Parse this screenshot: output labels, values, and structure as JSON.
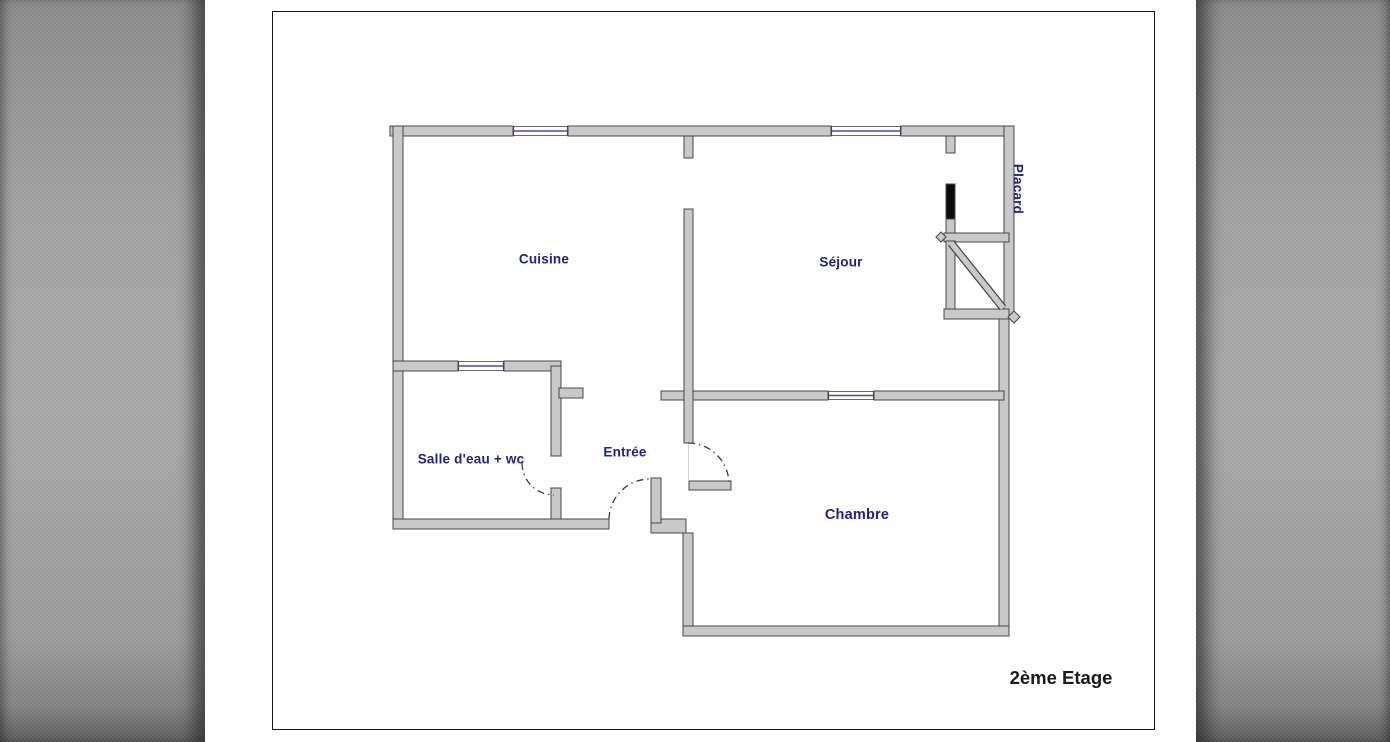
{
  "page": {
    "floor_title": "2ème Etage"
  },
  "rooms": {
    "cuisine": {
      "label": "Cuisine"
    },
    "sejour": {
      "label": "Séjour"
    },
    "placard": {
      "label": "Placard"
    },
    "salle_eau": {
      "label": "Salle d'eau + wc"
    },
    "entree": {
      "label": "Entrée"
    },
    "chambre": {
      "label": "Chambre"
    }
  },
  "colors": {
    "wall_fill": "#c9c9c9",
    "wall_outline": "#474747",
    "room_label": "#20208c",
    "title_text": "#1b1b1b",
    "window_line": "#4a4aa8",
    "door_arc": "#3c3c3c",
    "placard_door_fill": "#0b0b0b",
    "guide_line": "#d0d0d0",
    "page_background": "#ffffff",
    "gutter_gray": "#a0a0a0"
  },
  "floorplan": {
    "walls": [
      {
        "x": 117,
        "y": 114,
        "w": 123,
        "h": 10
      },
      {
        "x": 295,
        "y": 114,
        "w": 263,
        "h": 10
      },
      {
        "x": 628,
        "y": 114,
        "w": 113,
        "h": 10
      },
      {
        "x": 120,
        "y": 114,
        "w": 10,
        "h": 403
      },
      {
        "x": 731,
        "y": 114,
        "w": 10,
        "h": 193
      },
      {
        "x": 726,
        "y": 307,
        "w": 10,
        "h": 317
      },
      {
        "x": 120,
        "y": 349,
        "w": 65,
        "h": 10
      },
      {
        "x": 231,
        "y": 349,
        "w": 57,
        "h": 10
      },
      {
        "x": 278,
        "y": 354,
        "w": 10,
        "h": 90
      },
      {
        "x": 278,
        "y": 476,
        "w": 10,
        "h": 31
      },
      {
        "x": 286,
        "y": 376,
        "w": 24,
        "h": 10
      },
      {
        "x": 120,
        "y": 507,
        "w": 216,
        "h": 10
      },
      {
        "x": 378,
        "y": 507,
        "w": 35,
        "h": 14
      },
      {
        "x": 378,
        "y": 466,
        "w": 10,
        "h": 45
      },
      {
        "x": 410,
        "y": 521,
        "w": 10,
        "h": 103
      },
      {
        "x": 410,
        "y": 614,
        "w": 326,
        "h": 10
      },
      {
        "x": 388,
        "y": 379,
        "w": 167,
        "h": 9
      },
      {
        "x": 601,
        "y": 379,
        "w": 130,
        "h": 9
      },
      {
        "x": 411,
        "y": 124,
        "w": 9,
        "h": 22
      },
      {
        "x": 411,
        "y": 197,
        "w": 9,
        "h": 234
      },
      {
        "x": 416,
        "y": 469,
        "w": 42,
        "h": 9
      },
      {
        "x": 673,
        "y": 124,
        "w": 9,
        "h": 17
      },
      {
        "x": 673,
        "y": 172,
        "w": 9,
        "h": 37,
        "fill": "#0b0b0b",
        "name": "placard-door-leaf"
      },
      {
        "x": 673,
        "y": 207,
        "w": 9,
        "h": 14
      },
      {
        "x": 671,
        "y": 221,
        "w": 65,
        "h": 9
      },
      {
        "x": 673,
        "y": 229,
        "w": 9,
        "h": 78
      },
      {
        "x": 671,
        "y": 297,
        "w": 65,
        "h": 10
      }
    ],
    "windows": [
      {
        "x": 240,
        "y": 114,
        "w": 55,
        "h": 10,
        "line_y": 119
      },
      {
        "x": 558,
        "y": 114,
        "w": 70,
        "h": 10,
        "line_y": 119
      },
      {
        "x": 185,
        "y": 349,
        "w": 46,
        "h": 10,
        "line_y": 354
      },
      {
        "x": 555,
        "y": 379,
        "w": 46,
        "h": 9,
        "line_y": 383.5
      }
    ],
    "door_arcs": [
      {
        "d": "M 336 507 A 41 41 0 0 1 378 467",
        "name": "entree-door-arc"
      },
      {
        "d": "M 415 431 A 41 41 0 0 1 456 472",
        "name": "chambre-door-arc"
      },
      {
        "d": "M 249 451 A 32 32 0 0 0 281 483",
        "name": "salle-eau-door-arc"
      }
    ],
    "stairs_diagonal": {
      "x1": 678,
      "y1": 231,
      "x2": 730,
      "y2": 296
    },
    "bumps": [
      {
        "cx": 741,
        "cy": 305,
        "r": 6
      },
      {
        "cx": 668,
        "cy": 225,
        "r": 5
      }
    ],
    "guides": [
      {
        "x1": 415.5,
        "y1": 431,
        "x2": 415.5,
        "y2": 468
      }
    ]
  }
}
